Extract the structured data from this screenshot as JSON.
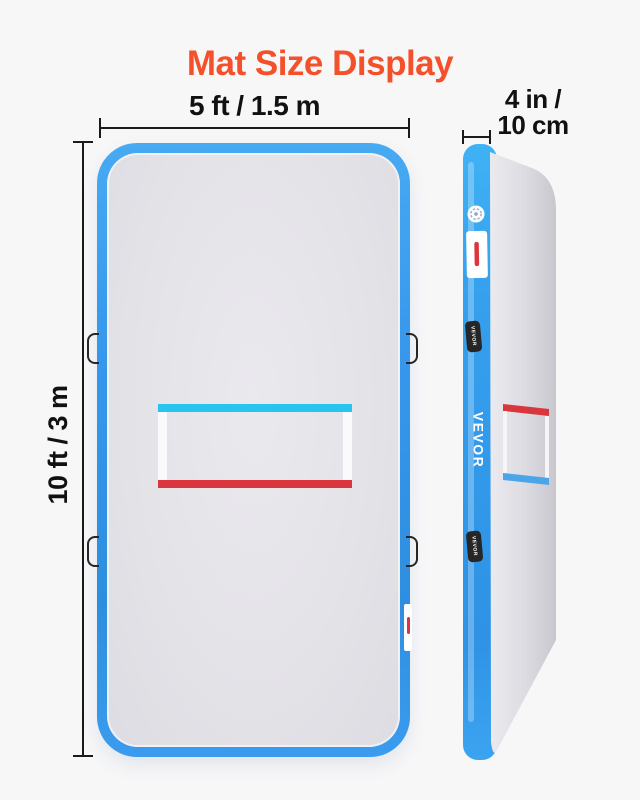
{
  "title": "Mat Size Display",
  "colors": {
    "accent": "#F4512B",
    "background": "#F7F7F8",
    "text": "#111111",
    "dim_line": "#1A1A1A",
    "mat_blue": "#3697EC",
    "mat_blue_deep": "#2E8FE0",
    "surface_gray": "#E4E3E8",
    "marking_cyan": "#27C4F0",
    "marking_red": "#D9363E",
    "side_marking_blue": "#4BA5E8",
    "handle_black": "#262626",
    "label_white": "#FFFFFF"
  },
  "dimensions": {
    "width_label": "5 ft / 1.5 m",
    "height_label": "10 ft / 3 m",
    "thickness_label_line1": "4 in /",
    "thickness_label_line2": "10 cm"
  },
  "side_view": {
    "brand_text": "VEVOR",
    "handle_labels": [
      "VEVOR",
      "VEVOR"
    ]
  }
}
